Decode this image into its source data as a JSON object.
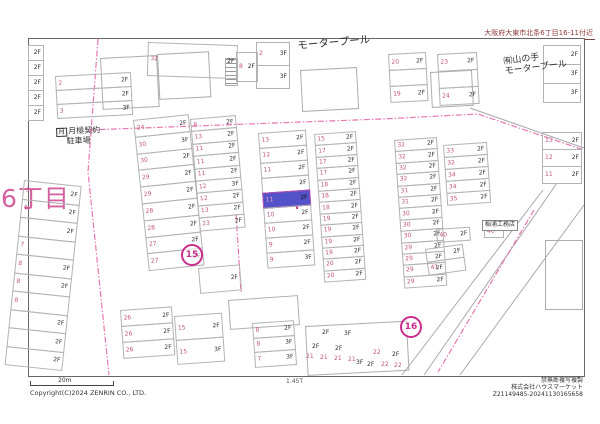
{
  "header": {
    "address": "大阪府大東市北条6丁目16-11付近"
  },
  "footer": {
    "scale_label": "20m",
    "ratio_label": "1.45T",
    "copyright": "Copyright(C)2024 ZENRIN CO., LTD.",
    "rights": "禁無断複写複製",
    "company": "株式会社ハウスマーケット",
    "serial": "Z21149485-20241130165658"
  },
  "map": {
    "colors": {
      "lot_number": "#c2557f",
      "floor_label": "#2f2f2f",
      "road_dash": "#e876b2",
      "building_outline": "#adadad",
      "subject_fill": "#5452c8",
      "accent": "#cb2d8c",
      "district_text": "#d460a0"
    },
    "district": {
      "text": "6丁目",
      "x": 1,
      "y": 186
    },
    "marker": {
      "glyph": "+",
      "x": 290,
      "y": 196
    },
    "circles": [
      {
        "t": "15",
        "x": 190,
        "y": 253
      },
      {
        "t": "16",
        "x": 409,
        "y": 325
      }
    ],
    "landmarks": [
      {
        "name": "motorpool-label",
        "lines": [
          "モータープール"
        ],
        "x": 297,
        "y": 40,
        "rot": -5,
        "size": 10.5
      },
      {
        "name": "yamanote-motorpool-label",
        "lines": [
          "㈲山の手",
          "モータープール"
        ],
        "x": 503,
        "y": 57,
        "rot": -7,
        "size": 9
      },
      {
        "name": "tsukigime-parking-label",
        "symbol": "月",
        "lines": [
          "月極契約",
          "駐車場"
        ],
        "x": 56,
        "y": 127,
        "rot": -2,
        "size": 8,
        "center2": true
      },
      {
        "name": "inaura-koumuten-label",
        "lines": [
          "稲浦工務店"
        ],
        "x": 482,
        "y": 220,
        "rot": 0,
        "size": 6,
        "box": true
      }
    ],
    "blocks": [
      {
        "x": 28,
        "y": 45,
        "w": 16,
        "rh": 16,
        "rot": 0,
        "rows": [
          {
            "f": "2F"
          },
          {
            "f": "2F"
          },
          {
            "f": "2F"
          },
          {
            "f": "2F"
          },
          {
            "f": "2F"
          }
        ]
      },
      {
        "x": 55,
        "y": 76,
        "w": 76,
        "rh": 15,
        "rot": -3,
        "rows": [
          {
            "n": "2",
            "f": "2F"
          },
          {
            "f": "2F"
          },
          {
            "n": "3",
            "f": "3F"
          }
        ]
      },
      {
        "x": 148,
        "y": 42,
        "w": 90,
        "rh": 34,
        "rot": 2,
        "rows": [
          {
            "n": "32",
            "f": "2F"
          }
        ]
      },
      {
        "x": 236,
        "y": 52,
        "w": 22,
        "rh": 30,
        "rot": 0,
        "rows": [
          {
            "n": "8",
            "f": "2F"
          }
        ]
      },
      {
        "x": 256,
        "y": 42,
        "w": 34,
        "rh": 24,
        "rot": 0,
        "rows": [
          {
            "n": "2",
            "f": "3F"
          },
          {
            "f": "3F"
          }
        ]
      },
      {
        "x": 388,
        "y": 54,
        "w": 38,
        "rh": 17,
        "rot": -3,
        "rows": [
          {
            "n": "20",
            "f": "2F"
          },
          {},
          {
            "n": "19",
            "f": "2F"
          }
        ]
      },
      {
        "x": 437,
        "y": 54,
        "w": 40,
        "rh": 18,
        "rot": -3,
        "rows": [
          {
            "n": "23",
            "f": "2F"
          },
          {},
          {
            "n": "24",
            "f": "2F"
          }
        ]
      },
      {
        "x": 543,
        "y": 45,
        "w": 38,
        "rh": 20,
        "rot": 0,
        "rows": [
          {
            "f": "2F"
          },
          {
            "f": "3F"
          },
          {
            "f": "3F"
          }
        ]
      },
      {
        "x": 542,
        "y": 132,
        "w": 40,
        "rh": 18,
        "rot": 0,
        "rows": [
          {
            "n": "13",
            "f": "2F"
          },
          {
            "n": "12",
            "f": "2F"
          },
          {
            "n": "11",
            "f": "2F"
          }
        ]
      },
      {
        "x": 133,
        "y": 120,
        "w": 56,
        "rh": 17.8,
        "rot": -6,
        "rows": [
          {
            "n": "24",
            "f": "2F"
          },
          {
            "n": "30",
            "f": "3F"
          },
          {
            "n": "30",
            "f": "2F"
          },
          {
            "n": "29",
            "f": "2F"
          },
          {
            "n": "29",
            "f": "2F"
          },
          {
            "n": "28",
            "f": "2F"
          },
          {
            "n": "28",
            "f": "2F"
          },
          {
            "n": "27",
            "f": "2F"
          },
          {
            "n": "27",
            "f": "2F"
          }
        ]
      },
      {
        "x": 190,
        "y": 119,
        "w": 46,
        "rh": 13.4,
        "rot": -5,
        "rows": [
          {
            "n": "8",
            "f": "2F"
          },
          {
            "n": "13",
            "f": "2F"
          },
          {
            "n": "11",
            "f": "2F"
          },
          {
            "n": "11",
            "f": "2F"
          },
          {
            "n": "11",
            "f": "2F"
          },
          {
            "n": "12",
            "f": "3F"
          },
          {
            "n": "12",
            "f": "2F"
          },
          {
            "n": "13",
            "f": "2F"
          },
          {
            "n": "23",
            "f": "2F"
          }
        ]
      },
      {
        "x": 198,
        "y": 268,
        "w": 42,
        "rh": 26,
        "rot": -5,
        "rows": [
          {
            "f": "2F"
          }
        ]
      },
      {
        "x": 258,
        "y": 133,
        "w": 48,
        "rh": 16,
        "rot": -4,
        "rows": [
          {
            "n": "13",
            "f": "2F"
          },
          {
            "n": "12",
            "f": "2F"
          },
          {
            "n": "11",
            "f": "2F"
          },
          {
            "f": "2F"
          },
          {
            "n": "11",
            "f": "2F",
            "s": true
          },
          {
            "n": "10",
            "f": "2F"
          },
          {
            "n": "10",
            "f": "2F"
          },
          {
            "n": "9",
            "f": "2F"
          },
          {
            "n": "9",
            "f": "3F"
          }
        ]
      },
      {
        "x": 314,
        "y": 134,
        "w": 42,
        "rh": 12.4,
        "rot": -4,
        "rows": [
          {
            "n": "15",
            "f": "2F"
          },
          {
            "n": "17",
            "f": "2F"
          },
          {
            "n": "17",
            "f": "2F"
          },
          {
            "n": "17",
            "f": "2F"
          },
          {
            "n": "18",
            "f": "2F"
          },
          {
            "n": "18",
            "f": "2F"
          },
          {
            "n": "18",
            "f": "2F"
          },
          {
            "n": "19",
            "f": "2F"
          },
          {
            "n": "19",
            "f": "2F"
          },
          {
            "n": "19",
            "f": "2F"
          },
          {
            "n": "19",
            "f": "2F"
          },
          {
            "n": "20",
            "f": "2F"
          },
          {
            "n": "20",
            "f": "2F"
          }
        ]
      },
      {
        "x": 394,
        "y": 140,
        "w": 43,
        "rh": 12.4,
        "rot": -4,
        "rows": [
          {
            "n": "32",
            "f": "2F"
          },
          {
            "n": "32",
            "f": "2F"
          },
          {
            "n": "32",
            "f": "2F"
          },
          {
            "n": "32",
            "f": "2F"
          },
          {
            "n": "31",
            "f": "2F"
          },
          {
            "n": "31",
            "f": "2F"
          },
          {
            "n": "30",
            "f": "2F"
          },
          {
            "n": "30",
            "f": "2F"
          },
          {
            "n": "30",
            "f": "2F"
          },
          {
            "n": "29",
            "f": "2F"
          },
          {
            "n": "29",
            "f": "2F"
          },
          {
            "n": "29",
            "f": "2F"
          },
          {
            "n": "29",
            "f": "2F"
          }
        ]
      },
      {
        "x": 443,
        "y": 145,
        "w": 44,
        "rh": 13,
        "rot": -4,
        "rows": [
          {
            "n": "33",
            "f": "2F"
          },
          {
            "n": "32",
            "f": "2F"
          },
          {
            "n": "34",
            "f": "2F"
          },
          {
            "n": "34",
            "f": "2F"
          },
          {
            "n": "35",
            "f": "2F"
          }
        ]
      },
      {
        "x": 436,
        "y": 229,
        "w": 34,
        "rh": 14,
        "rot": -4,
        "rows": [
          {
            "n": "40",
            "f": "2F"
          }
        ]
      },
      {
        "x": 425,
        "y": 249,
        "w": 38,
        "rh": 14,
        "rot": -8,
        "rows": [
          {
            "f": "2F"
          },
          {
            "n": "41"
          }
        ]
      },
      {
        "x": 484,
        "y": 226,
        "w": 20,
        "rh": 12,
        "rot": 0,
        "rows": [
          {
            "n": "40"
          }
        ]
      },
      {
        "x": 24,
        "y": 180,
        "w": 58,
        "rh": 19.5,
        "rot": 6,
        "rows": [
          {
            "n": "5",
            "f": "2F"
          },
          {
            "n": "6",
            "f": "2F"
          },
          {
            "f": "2F"
          },
          {
            "n": "7"
          },
          {
            "n": "8",
            "f": "2F"
          },
          {
            "n": "8",
            "f": "2F"
          },
          {
            "n": "8"
          },
          {
            "f": "2F"
          },
          {
            "f": "2F"
          },
          {
            "f": "2F"
          }
        ]
      },
      {
        "x": 120,
        "y": 310,
        "w": 52,
        "rh": 17,
        "rot": -4,
        "rows": [
          {
            "n": "26",
            "f": "2F"
          },
          {
            "n": "26",
            "f": "2F"
          },
          {
            "n": "26",
            "f": "2F"
          }
        ]
      },
      {
        "x": 174,
        "y": 316,
        "w": 48,
        "rh": 25,
        "rot": -4,
        "rows": [
          {
            "n": "15",
            "f": "2F"
          },
          {
            "n": "15",
            "f": "3F"
          }
        ]
      },
      {
        "x": 252,
        "y": 323,
        "w": 42,
        "rh": 15.5,
        "rot": -4,
        "rows": [
          {
            "n": "8",
            "f": "2F"
          },
          {
            "n": "8",
            "f": "3F"
          },
          {
            "n": "7",
            "f": "3F"
          }
        ]
      }
    ],
    "freelabels": [
      {
        "t": "2F",
        "x": 322,
        "y": 330
      },
      {
        "t": "3F",
        "x": 344,
        "y": 331
      },
      {
        "t": "2F",
        "x": 312,
        "y": 344
      },
      {
        "t": "2F",
        "x": 335,
        "y": 346
      },
      {
        "t": "21",
        "x": 306,
        "y": 354,
        "m": true
      },
      {
        "t": "21",
        "x": 320,
        "y": 355,
        "m": true
      },
      {
        "t": "21",
        "x": 334,
        "y": 356,
        "m": true
      },
      {
        "t": "21",
        "x": 348,
        "y": 357,
        "m": true
      },
      {
        "t": "22",
        "x": 373,
        "y": 350,
        "m": true
      },
      {
        "t": "2F",
        "x": 392,
        "y": 352
      },
      {
        "t": "3F",
        "x": 356,
        "y": 360
      },
      {
        "t": "2F",
        "x": 367,
        "y": 362
      },
      {
        "t": "22",
        "x": 381,
        "y": 362,
        "m": true
      },
      {
        "t": "22",
        "x": 394,
        "y": 363,
        "m": true
      }
    ],
    "shapes": [
      {
        "x": 100,
        "y": 58,
        "w": 55,
        "h": 50,
        "rot": -3
      },
      {
        "x": 157,
        "y": 54,
        "w": 50,
        "h": 44,
        "rot": -3
      },
      {
        "x": 225,
        "y": 58,
        "w": 11,
        "h": 26,
        "rot": 0,
        "hatch": true
      },
      {
        "x": 300,
        "y": 70,
        "w": 55,
        "h": 40,
        "rot": -3
      },
      {
        "x": 430,
        "y": 72,
        "w": 40,
        "h": 34,
        "rot": -3
      },
      {
        "x": 545,
        "y": 240,
        "w": 36,
        "h": 68,
        "rot": 0
      },
      {
        "x": 228,
        "y": 300,
        "w": 68,
        "h": 28,
        "rot": -4
      },
      {
        "x": 305,
        "y": 326,
        "w": 100,
        "h": 48,
        "rot": -3
      }
    ],
    "roads_dashed": [
      "98,39 88,172 109,375",
      "88,130 382,119 478,114 584,150",
      "534,210 470,318 438,372",
      "236,214 241,292"
    ],
    "lines_solid": [
      "557,183 424,375",
      "543,190 402,375",
      "584,205 460,375",
      "470,108 584,148"
    ]
  }
}
